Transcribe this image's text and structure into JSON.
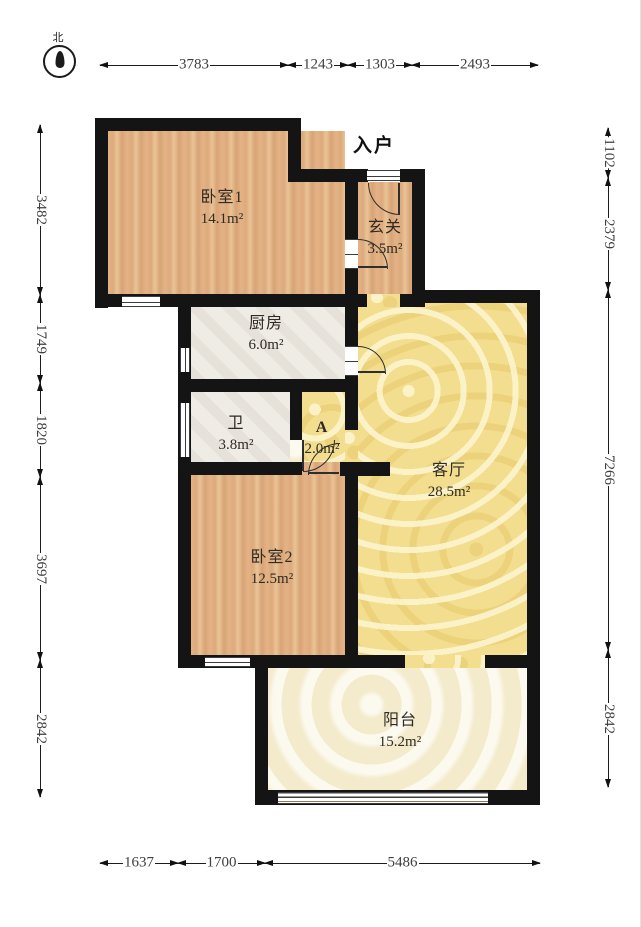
{
  "compass": {
    "north_label": "北"
  },
  "entry": {
    "label": "入户"
  },
  "rooms": {
    "bedroom1": {
      "name": "卧室1",
      "area": "14.1m²"
    },
    "hallway": {
      "name": "玄关",
      "area": "3.5m²"
    },
    "kitchen": {
      "name": "厨房",
      "area": "6.0m²"
    },
    "bathroom": {
      "name": "卫",
      "area": "3.8m²"
    },
    "corridor": {
      "name": "A",
      "area": "2.0m²"
    },
    "living": {
      "name": "客厅",
      "area": "28.5m²"
    },
    "bedroom2": {
      "name": "卧室2",
      "area": "12.5m²"
    },
    "balcony": {
      "name": "阳台",
      "area": "15.2m²"
    }
  },
  "dimensions": {
    "top": [
      "3783",
      "1243",
      "1303",
      "2493"
    ],
    "bottom": [
      "1637",
      "1700",
      "5486"
    ],
    "left": [
      "3482",
      "1749",
      "1820",
      "3697",
      "2842"
    ],
    "right": [
      "1102",
      "2379",
      "7266",
      "2842"
    ]
  },
  "colors": {
    "wall": "#141414",
    "wood_floor": "#dfae80",
    "living_floor": "#f3dd8f",
    "tile_floor": "#efece5",
    "balcony_floor": "#f7f0d7",
    "dimension_text": "#3e3e3e"
  }
}
